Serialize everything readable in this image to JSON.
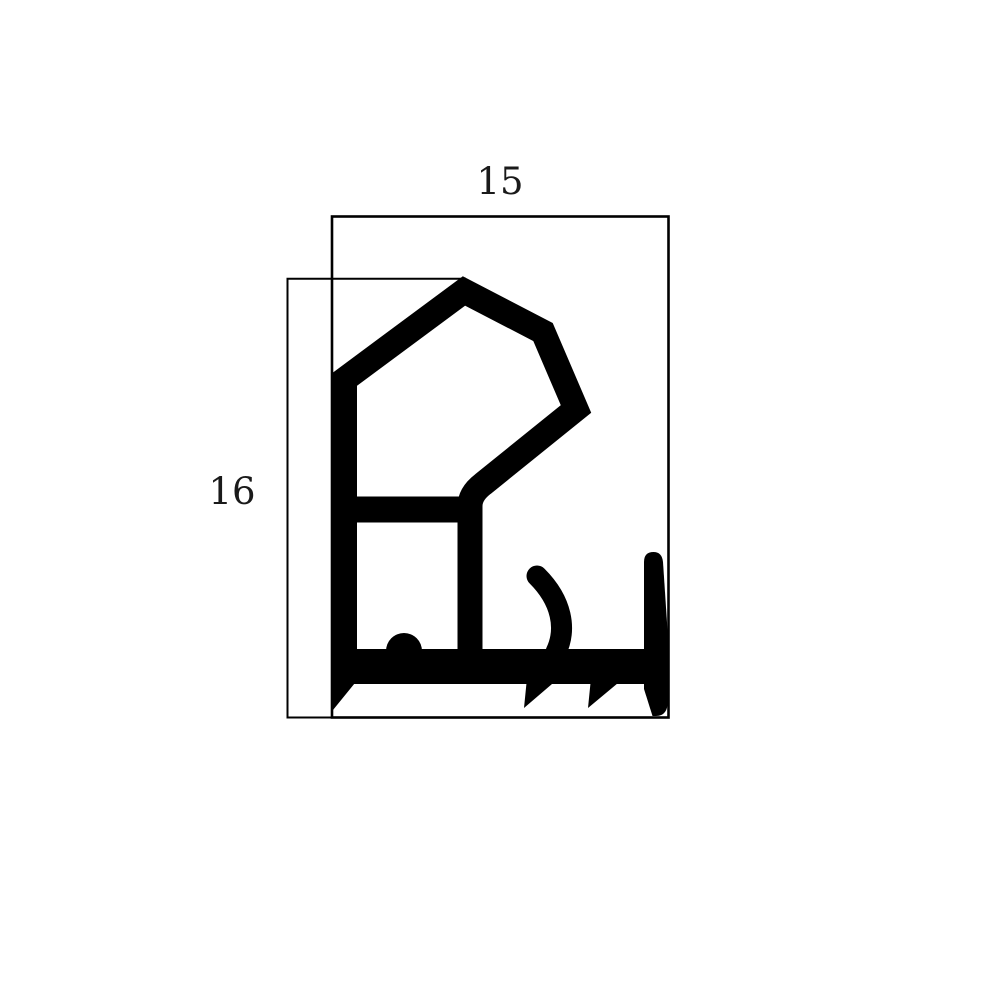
{
  "drawing": {
    "background": "#ffffff",
    "line_color": "#000000",
    "profile_color": "#000000",
    "label_color": "#1a1a1a",
    "width_dimension": {
      "label": "15"
    },
    "height_dimension": {
      "label": "16"
    }
  }
}
